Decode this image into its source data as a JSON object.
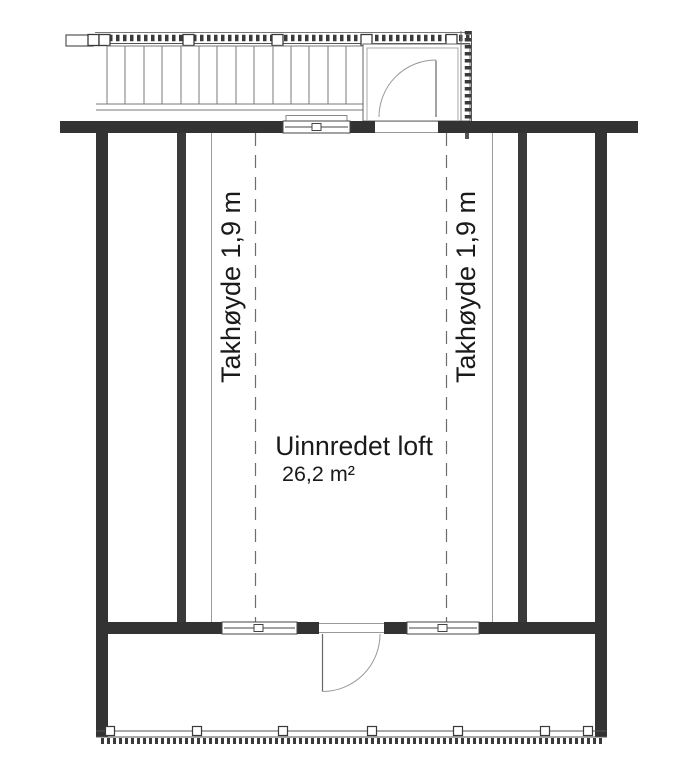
{
  "plan": {
    "room": {
      "name": "Uinnredet loft",
      "area": "26,2 m²"
    },
    "annotations": {
      "ceiling_left": "Takhøyde 1,9 m",
      "ceiling_right": "Takhøyde 1,9 m"
    },
    "colors": {
      "wall": "#333333",
      "outline": "#555555",
      "thin_line": "#999999",
      "dashed_line": "#6e6e6e",
      "background": "#ffffff",
      "text": "#1a1a1a"
    },
    "symbols": {
      "stairs": "exterior-stair-run",
      "landing": "entry-landing-with-railing",
      "entry_door": "door-swing-quarter-arc",
      "balcony_door": "door-swing-quarter-arc",
      "windows": [
        "top-wall-window",
        "bottom-wall-window-left",
        "bottom-wall-window-right"
      ],
      "railings": [
        "walkway-railing-hatched",
        "balcony-railing-hatched"
      ]
    }
  }
}
